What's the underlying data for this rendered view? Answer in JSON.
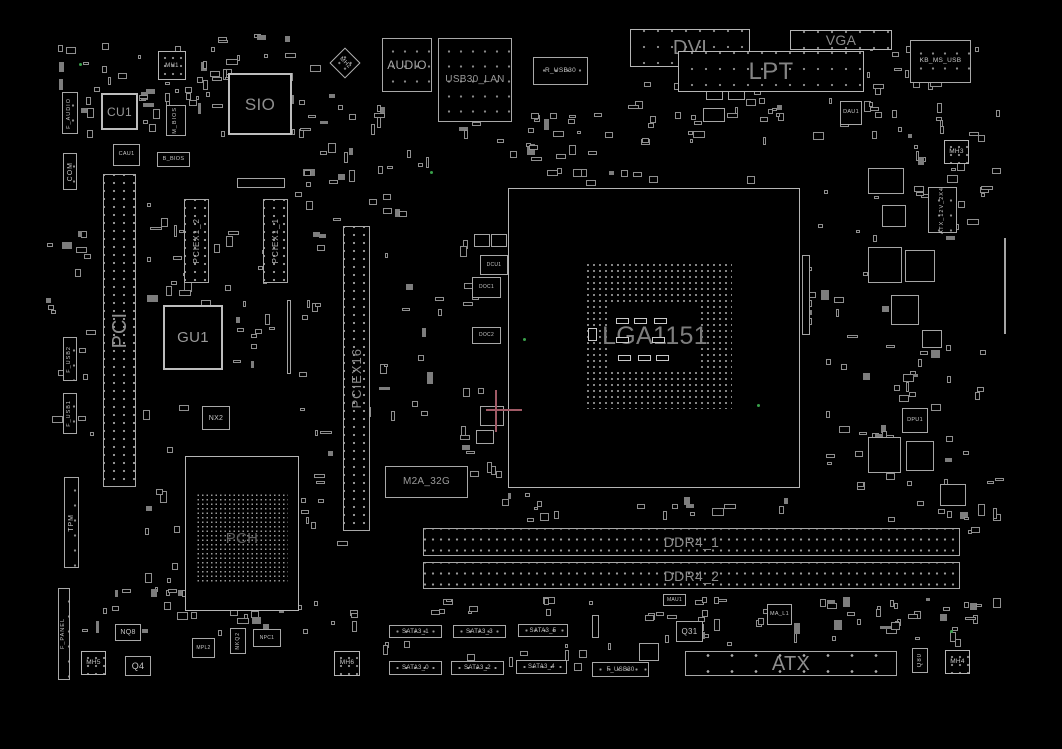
{
  "palette": {
    "background": "#000000",
    "line": "#a8a8a8",
    "label_small": "#c6c6c6",
    "label_large": "#8d8d8d",
    "test_point_green": "#39a04a",
    "crosshair_pink": "#a05a66"
  },
  "components": [
    {
      "n": "cpu-socket-outline",
      "x": 508,
      "y": 188,
      "w": 292,
      "h": 300,
      "c": "sock",
      "i": true
    },
    {
      "n": "cpu-socket-pins",
      "x": 585,
      "y": 262,
      "w": 147,
      "h": 147,
      "c": "pins",
      "i": false
    },
    {
      "n": "cpu-socket-center",
      "t": "LGA1151",
      "x": 610,
      "y": 305,
      "w": 90,
      "h": 63,
      "c": "mask",
      "fs": 25,
      "lc": "#7d7d7d",
      "i": false
    },
    {
      "n": "pch-outline",
      "x": 185,
      "y": 456,
      "w": 114,
      "h": 155,
      "c": "sock",
      "i": true
    },
    {
      "n": "pch-bga",
      "t": "PCH",
      "x": 196,
      "y": 493,
      "w": 92,
      "h": 90,
      "c": "pins4",
      "fs": 15,
      "lc": "#5f5f5f",
      "i": false
    },
    {
      "n": "slot-pci",
      "t": "PCI",
      "x": 103,
      "y": 174,
      "w": 33,
      "h": 313,
      "c": "slotv",
      "v": true,
      "fs": 20,
      "lc": "#8d8d8d",
      "i": true
    },
    {
      "n": "slot-pciex1-2",
      "t": "PCIEX1_2",
      "x": 184,
      "y": 199,
      "w": 25,
      "h": 84,
      "c": "slotv",
      "v": true,
      "fs": 8,
      "lc": "#b5b5b5",
      "i": true
    },
    {
      "n": "slot-pciex1-1",
      "t": "PCIEX1_1",
      "x": 263,
      "y": 199,
      "w": 25,
      "h": 84,
      "c": "slotv",
      "v": true,
      "fs": 8,
      "lc": "#b5b5b5",
      "i": true
    },
    {
      "n": "slot-pciex16",
      "t": "PCIEX16",
      "x": 343,
      "y": 226,
      "w": 27,
      "h": 305,
      "c": "slotv",
      "v": true,
      "fs": 13,
      "lc": "#8d8d8d",
      "i": true
    },
    {
      "n": "chip-gu1",
      "t": "GU1",
      "x": 163,
      "y": 305,
      "w": 60,
      "h": 65,
      "c": "chipb",
      "fs": 15,
      "lc": "#9a9a9a",
      "i": true
    },
    {
      "n": "chip-nx2",
      "t": "NX2",
      "x": 202,
      "y": 406,
      "w": 28,
      "h": 24,
      "c": "chip",
      "fs": 7,
      "i": true
    },
    {
      "n": "conn-m2a-32g",
      "t": "M2A_32G",
      "x": 385,
      "y": 466,
      "w": 83,
      "h": 32,
      "c": "chip",
      "fs": 10,
      "lc": "#9a9a9a",
      "i": true
    },
    {
      "n": "chip-cu1",
      "t": "CU1",
      "x": 101,
      "y": 93,
      "w": 37,
      "h": 37,
      "c": "chipb",
      "fs": 12,
      "lc": "#9a9a9a",
      "i": true
    },
    {
      "n": "chip-sio",
      "t": "SIO",
      "x": 228,
      "y": 73,
      "w": 64,
      "h": 62,
      "c": "chipb",
      "fs": 17,
      "lc": "#8f8f8f",
      "i": true
    },
    {
      "n": "hole-mh1",
      "t": "MH1",
      "x": 158,
      "y": 51,
      "w": 28,
      "h": 29,
      "c": "hole",
      "fs": 6,
      "i": false
    },
    {
      "n": "hole-mh2",
      "t": "MH2",
      "x": 334,
      "y": 52,
      "w": 22,
      "h": 22,
      "c": "hole",
      "rot": 45,
      "fs": 6,
      "i": false
    },
    {
      "n": "chip-m-bios",
      "t": "M_BIOS",
      "x": 166,
      "y": 105,
      "w": 20,
      "h": 31,
      "c": "chip",
      "v": true,
      "fs": 5.5,
      "i": true
    },
    {
      "n": "chip-cau1",
      "t": "CAU1",
      "x": 113,
      "y": 144,
      "w": 27,
      "h": 22,
      "c": "chip",
      "fs": 5.5,
      "i": true
    },
    {
      "n": "chip-b-bios",
      "t": "B_BIOS",
      "x": 157,
      "y": 152,
      "w": 33,
      "h": 15,
      "c": "chip",
      "fs": 5.5,
      "i": true
    },
    {
      "n": "conn-f-audio",
      "t": "F_AUDIO",
      "x": 62,
      "y": 92,
      "w": 16,
      "h": 42,
      "c": "conn",
      "v": true,
      "fs": 5.5,
      "i": true
    },
    {
      "n": "conn-com",
      "t": "COM",
      "x": 63,
      "y": 153,
      "w": 14,
      "h": 37,
      "c": "conn",
      "v": true,
      "fs": 7,
      "i": true
    },
    {
      "n": "conn-f-usb2",
      "t": "F_USB2",
      "x": 63,
      "y": 337,
      "w": 14,
      "h": 44,
      "c": "conn",
      "v": true,
      "fs": 5.5,
      "i": true
    },
    {
      "n": "conn-f-usb1",
      "t": "F_USB1",
      "x": 63,
      "y": 393,
      "w": 14,
      "h": 41,
      "c": "conn",
      "v": true,
      "fs": 5.5,
      "i": true
    },
    {
      "n": "conn-tpm",
      "t": "TPM",
      "x": 64,
      "y": 477,
      "w": 15,
      "h": 91,
      "c": "conn",
      "v": true,
      "fs": 7,
      "i": true
    },
    {
      "n": "conn-f-panel",
      "t": "F_PANEL",
      "x": 58,
      "y": 588,
      "w": 12,
      "h": 92,
      "c": "conn",
      "v": true,
      "fs": 5.5,
      "i": true
    },
    {
      "n": "io-audio",
      "t": "AUDIO",
      "x": 382,
      "y": 38,
      "w": 50,
      "h": 54,
      "c": "conn",
      "fs": 12,
      "lc": "#a8a8a8",
      "i": true
    },
    {
      "n": "io-usb30-lan",
      "t": "USB30_LAN",
      "x": 438,
      "y": 38,
      "w": 74,
      "h": 84,
      "c": "conn",
      "fs": 10,
      "lc": "#9a9a9a",
      "i": true
    },
    {
      "n": "conn-r-usb30",
      "t": "R_USB30",
      "x": 533,
      "y": 57,
      "w": 55,
      "h": 28,
      "c": "conn",
      "fs": 6.5,
      "i": true
    },
    {
      "n": "io-dvi",
      "t": "DVI",
      "x": 630,
      "y": 29,
      "w": 120,
      "h": 38,
      "c": "io",
      "fs": 20,
      "lc": "#8a8a8a",
      "i": true
    },
    {
      "n": "io-vga",
      "t": "VGA",
      "x": 790,
      "y": 30,
      "w": 102,
      "h": 20,
      "c": "io",
      "fs": 14,
      "lc": "#8a8a8a",
      "i": true
    },
    {
      "n": "io-lpt",
      "t": "LPT",
      "x": 678,
      "y": 51,
      "w": 186,
      "h": 41,
      "c": "io",
      "fs": 24,
      "lc": "#848484",
      "i": true
    },
    {
      "n": "io-kb-ms-usb",
      "t": "KB_MS_USB",
      "x": 910,
      "y": 40,
      "w": 61,
      "h": 43,
      "c": "conn",
      "fs": 6.5,
      "i": true
    },
    {
      "n": "chip-dau1",
      "t": "DAU1",
      "x": 840,
      "y": 101,
      "w": 22,
      "h": 24,
      "c": "chip",
      "fs": 5.5,
      "i": true
    },
    {
      "n": "hole-mh3",
      "t": "MH3",
      "x": 944,
      "y": 140,
      "w": 25,
      "h": 24,
      "c": "hole",
      "fs": 6.5,
      "i": false
    },
    {
      "n": "conn-atx-12v-2x4",
      "t": "ATX_12V_2X4",
      "x": 928,
      "y": 187,
      "w": 29,
      "h": 46,
      "c": "conn",
      "v": true,
      "fs": 5.5,
      "i": true
    },
    {
      "n": "chip-dcu1",
      "t": "DCU1",
      "x": 480,
      "y": 255,
      "w": 28,
      "h": 20,
      "c": "chip",
      "fs": 5,
      "i": true
    },
    {
      "n": "chip-doc1",
      "t": "DOC1",
      "x": 472,
      "y": 277,
      "w": 29,
      "h": 21,
      "c": "chip",
      "fs": 5,
      "i": true
    },
    {
      "n": "chip-doc2",
      "t": "DOC2",
      "x": 472,
      "y": 327,
      "w": 29,
      "h": 17,
      "c": "chip",
      "fs": 5,
      "i": true
    },
    {
      "n": "chip-dpu1",
      "t": "DPU1",
      "x": 902,
      "y": 408,
      "w": 26,
      "h": 25,
      "c": "chip",
      "fs": 5.5,
      "i": true
    },
    {
      "n": "slot-ddr4-1",
      "t": "DDR4_1",
      "x": 423,
      "y": 528,
      "w": 537,
      "h": 28,
      "c": "sloth",
      "fs": 14,
      "lc": "#8d8d8d",
      "i": true
    },
    {
      "n": "slot-ddr4-2",
      "t": "DDR4_2",
      "x": 423,
      "y": 562,
      "w": 537,
      "h": 27,
      "c": "sloth",
      "fs": 14,
      "lc": "#8d8d8d",
      "i": true
    },
    {
      "n": "conn-sata3-1",
      "t": "SATA3_1",
      "x": 389,
      "y": 625,
      "w": 53,
      "h": 13,
      "c": "sata",
      "fs": 6,
      "i": true
    },
    {
      "n": "conn-sata3-3",
      "t": "SATA3_3",
      "x": 453,
      "y": 625,
      "w": 53,
      "h": 13,
      "c": "sata",
      "fs": 6,
      "i": true
    },
    {
      "n": "conn-sata3-5",
      "t": "SATA3_5",
      "x": 518,
      "y": 624,
      "w": 50,
      "h": 13,
      "c": "sata",
      "fs": 6,
      "i": true
    },
    {
      "n": "conn-sata3-0",
      "t": "SATA3_0",
      "x": 389,
      "y": 661,
      "w": 53,
      "h": 14,
      "c": "sata",
      "fs": 6,
      "i": true
    },
    {
      "n": "conn-sata3-2",
      "t": "SATA3_2",
      "x": 451,
      "y": 661,
      "w": 53,
      "h": 14,
      "c": "sata",
      "fs": 6,
      "i": true
    },
    {
      "n": "conn-sata3-4",
      "t": "SATA3_4",
      "x": 516,
      "y": 660,
      "w": 51,
      "h": 14,
      "c": "sata",
      "fs": 6,
      "i": true
    },
    {
      "n": "conn-f-usb30",
      "t": "F_USB30",
      "x": 592,
      "y": 662,
      "w": 57,
      "h": 15,
      "c": "sata",
      "fs": 6,
      "i": true
    },
    {
      "n": "chip-mau1",
      "t": "MAU1",
      "x": 663,
      "y": 594,
      "w": 23,
      "h": 12,
      "c": "chip",
      "fs": 5,
      "i": true
    },
    {
      "n": "chip-q31",
      "t": "Q31",
      "x": 676,
      "y": 621,
      "w": 27,
      "h": 21,
      "c": "chip",
      "fs": 8,
      "i": true
    },
    {
      "n": "chip-ma-l1",
      "t": "MA_L1",
      "x": 767,
      "y": 604,
      "w": 25,
      "h": 21,
      "c": "chip",
      "fs": 5.5,
      "i": true
    },
    {
      "n": "conn-atx",
      "t": "ATX",
      "x": 685,
      "y": 651,
      "w": 212,
      "h": 25,
      "c": "atx",
      "fs": 20,
      "lc": "#8d8d8d",
      "i": true
    },
    {
      "n": "chip-q80",
      "t": "Q80",
      "x": 912,
      "y": 648,
      "w": 16,
      "h": 25,
      "c": "chip",
      "v": true,
      "fs": 6,
      "i": true
    },
    {
      "n": "hole-mh4",
      "t": "MH4",
      "x": 945,
      "y": 650,
      "w": 25,
      "h": 24,
      "c": "hole",
      "fs": 6.5,
      "i": false
    },
    {
      "n": "hole-mh5",
      "t": "MH5",
      "x": 81,
      "y": 651,
      "w": 25,
      "h": 24,
      "c": "hole",
      "fs": 6.5,
      "i": false
    },
    {
      "n": "hole-mh6",
      "t": "MH6",
      "x": 334,
      "y": 651,
      "w": 26,
      "h": 25,
      "c": "hole",
      "fs": 6.5,
      "i": false
    },
    {
      "n": "chip-nq8",
      "t": "NQ8",
      "x": 115,
      "y": 624,
      "w": 26,
      "h": 17,
      "c": "chip",
      "fs": 7,
      "i": true
    },
    {
      "n": "chip-q4",
      "t": "Q4",
      "x": 125,
      "y": 656,
      "w": 26,
      "h": 20,
      "c": "chip",
      "fs": 9,
      "i": true
    },
    {
      "n": "chip-mpl2",
      "t": "MPL2",
      "x": 192,
      "y": 638,
      "w": 23,
      "h": 20,
      "c": "chip",
      "fs": 5,
      "i": true
    },
    {
      "n": "chip-nkq2",
      "t": "NKQ2",
      "x": 230,
      "y": 628,
      "w": 16,
      "h": 26,
      "c": "chip",
      "v": true,
      "fs": 5,
      "i": true
    },
    {
      "n": "chip-npc1",
      "t": "NPC1",
      "x": 253,
      "y": 629,
      "w": 28,
      "h": 18,
      "c": "chip",
      "fs": 5,
      "i": true
    }
  ],
  "decor": {
    "clusters": [
      [
        55,
        30,
        255,
        112,
        64
      ],
      [
        196,
        46,
        52,
        82,
        12
      ],
      [
        296,
        60,
        62,
        132,
        18
      ],
      [
        370,
        96,
        20,
        40,
        5
      ],
      [
        455,
        120,
        150,
        42,
        14
      ],
      [
        520,
        96,
        70,
        38,
        8
      ],
      [
        590,
        78,
        115,
        68,
        16
      ],
      [
        700,
        48,
        64,
        78,
        10
      ],
      [
        755,
        95,
        130,
        55,
        14
      ],
      [
        862,
        45,
        118,
        128,
        26
      ],
      [
        935,
        95,
        70,
        148,
        12
      ],
      [
        140,
        180,
        102,
        188,
        24
      ],
      [
        215,
        235,
        112,
        138,
        16
      ],
      [
        293,
        190,
        52,
        188,
        10
      ],
      [
        378,
        225,
        68,
        228,
        14
      ],
      [
        458,
        232,
        52,
        250,
        18
      ],
      [
        46,
        195,
        52,
        288,
        20
      ],
      [
        802,
        250,
        14,
        88,
        7
      ],
      [
        818,
        180,
        85,
        318,
        24
      ],
      [
        855,
        335,
        150,
        192,
        40
      ],
      [
        900,
        150,
        95,
        52,
        8
      ],
      [
        142,
        385,
        64,
        212,
        20
      ],
      [
        300,
        390,
        84,
        198,
        14
      ],
      [
        480,
        490,
        108,
        32,
        8
      ],
      [
        598,
        496,
        300,
        24,
        10
      ],
      [
        905,
        500,
        98,
        36,
        8
      ],
      [
        428,
        596,
        532,
        26,
        26
      ],
      [
        78,
        588,
        288,
        48,
        28
      ],
      [
        372,
        640,
        252,
        36,
        14
      ],
      [
        660,
        592,
        242,
        54,
        28
      ],
      [
        905,
        588,
        100,
        86,
        14
      ],
      [
        540,
        168,
        240,
        20,
        10
      ],
      [
        368,
        128,
        80,
        90,
        10
      ]
    ],
    "boxes": [
      [
        868,
        168,
        36,
        26
      ],
      [
        882,
        205,
        24,
        22
      ],
      [
        868,
        247,
        34,
        36
      ],
      [
        905,
        250,
        30,
        32
      ],
      [
        891,
        295,
        28,
        30
      ],
      [
        922,
        330,
        20,
        18
      ],
      [
        868,
        437,
        33,
        36
      ],
      [
        906,
        441,
        28,
        30
      ],
      [
        940,
        484,
        26,
        22
      ],
      [
        706,
        57,
        17,
        19
      ],
      [
        728,
        57,
        17,
        19
      ],
      [
        706,
        81,
        17,
        19
      ],
      [
        728,
        81,
        17,
        19
      ],
      [
        703,
        108,
        22,
        14
      ],
      [
        474,
        234,
        16,
        13
      ],
      [
        491,
        234,
        16,
        13
      ],
      [
        508,
        235,
        13,
        15
      ],
      [
        480,
        406,
        24,
        20
      ],
      [
        476,
        430,
        18,
        14
      ],
      [
        592,
        615,
        7,
        23
      ],
      [
        639,
        643,
        20,
        18
      ],
      [
        1004,
        238,
        2,
        96
      ],
      [
        287,
        300,
        4,
        74
      ],
      [
        237,
        178,
        48,
        10
      ],
      [
        802,
        255,
        8,
        80
      ]
    ],
    "caps": [
      [
        616,
        318,
        13,
        6
      ],
      [
        634,
        318,
        13,
        6
      ],
      [
        654,
        318,
        13,
        6
      ],
      [
        616,
        337,
        13,
        6
      ],
      [
        652,
        337,
        13,
        6
      ],
      [
        618,
        355,
        13,
        6
      ],
      [
        638,
        355,
        13,
        6
      ],
      [
        656,
        355,
        13,
        6
      ],
      [
        588,
        328,
        9,
        13
      ]
    ],
    "green_dots": [
      [
        79,
        63
      ],
      [
        430,
        171
      ],
      [
        523,
        338
      ],
      [
        757,
        404
      ],
      [
        950,
        630
      ]
    ],
    "pink_lines": [
      [
        486,
        409,
        36,
        2
      ],
      [
        495,
        390,
        2,
        42
      ]
    ]
  }
}
